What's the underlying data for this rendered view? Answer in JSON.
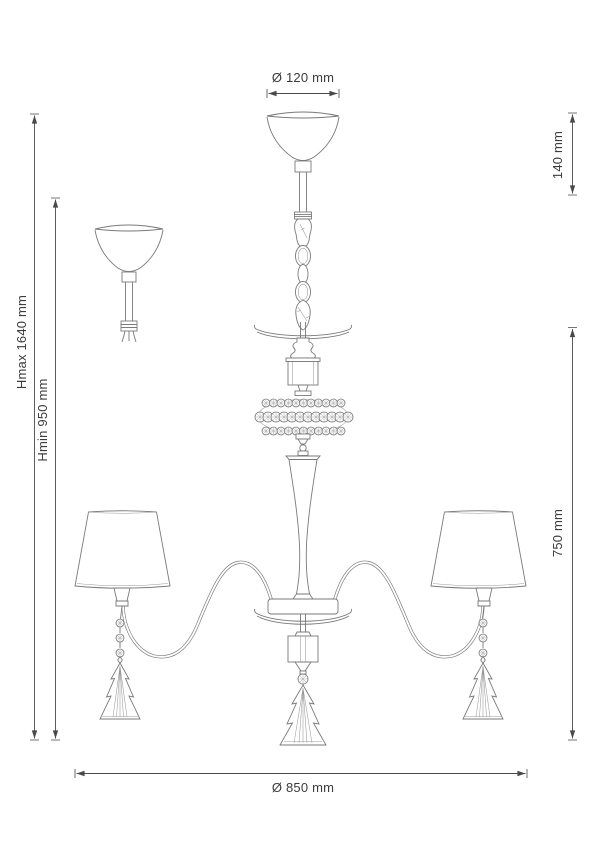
{
  "drawing": {
    "title": "chandelier-dimension-drawing",
    "dimensions": {
      "canopy_diameter": "Ø 120 mm",
      "suspension_height": "140 mm",
      "body_height": "750 mm",
      "max_height": "Hmax 1640 mm",
      "min_height": "Hmin 950 mm",
      "fixture_diameter": "Ø 850 mm"
    },
    "colors": {
      "background": "#ffffff",
      "drawing_line": "#7a7a7a",
      "dimension_line": "#4a4a4a",
      "text": "#3c3c3c"
    }
  }
}
